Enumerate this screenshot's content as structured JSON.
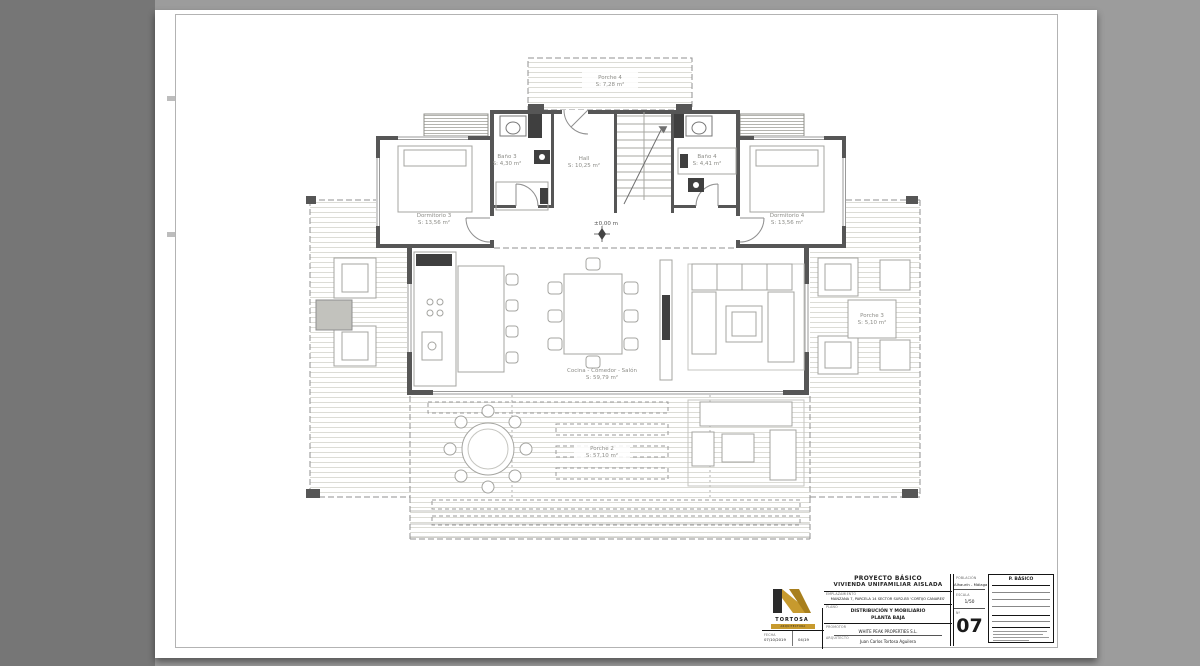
{
  "colors": {
    "logo_gold": "#c79a2e",
    "wall": "#565656"
  },
  "plan": {
    "level_marker": "±0,00 m",
    "rooms": [
      {
        "name": "Porche 4",
        "area": "S: 7,28 m²"
      },
      {
        "name": "Baño 3",
        "area": "S: 4,30 m²"
      },
      {
        "name": "Hall",
        "area": "S: 10,25 m²"
      },
      {
        "name": "Baño 4",
        "area": "S: 4,41 m²"
      },
      {
        "name": "Dormitorio 3",
        "area": "S: 13,56 m²"
      },
      {
        "name": "Dormitorio 4",
        "area": "S: 13,56 m²"
      },
      {
        "name": "Cocina - Comedor - Salón",
        "area": "S: 59,79 m²"
      },
      {
        "name": "Porche 2",
        "area": "S: 57,10 m²"
      },
      {
        "name": "Porche 3",
        "area": "S: 5,10 m²"
      }
    ]
  },
  "titleblock": {
    "project_title_1": "PROYECTO BÁSICO",
    "project_title_2": "VIVIENDA UNIFAMILIAR AISLADA",
    "site_label": "EMPLAZAMIENTO",
    "site_value": "MANZANA 7, PARCELA 14 SECTOR SUR2-B5 'CORTIJO CANARES'",
    "drawing_label": "PLANO",
    "drawing_title_1": "DISTRIBUCIÓN Y MOBILIARIO",
    "drawing_title_2": "PLANTA BAJA",
    "promoter_label": "PROMOTOR",
    "promoter_value": "WHITE PEAK PROPERTIES S.L.",
    "architect_label": "ARQUITECTO",
    "architect_value": "Juan Carlos Tortosa Aguilera",
    "location_label": "POBLACIÓN",
    "location_value": "Alhaurín - Málaga",
    "scale_label": "ESCALA",
    "scale_value": "1/50",
    "number_label": "Nº",
    "sheet_number": "07",
    "date_label": "FECHA",
    "date_value": "07/10/2019",
    "revision_value": "04/19",
    "phase_box_title": "P. BÁSICO",
    "logo_text": "TORTOSA",
    "logo_subtext": "ARQUITECTURA"
  }
}
